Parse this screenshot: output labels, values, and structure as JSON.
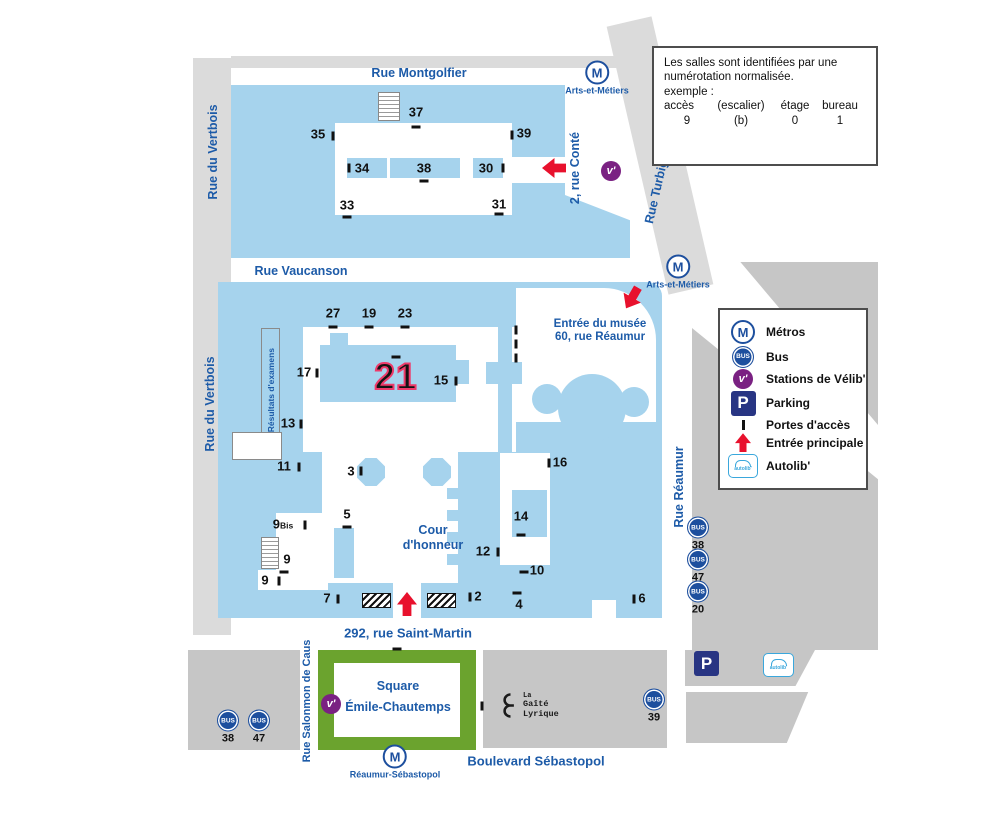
{
  "colors": {
    "campus": "#A6D3ED",
    "street": "#DBDBDB",
    "block": "#C6C6C6",
    "green": "#6BA32E",
    "blue_text": "#1D5BA8",
    "metro_blue": "#1D4F9E",
    "velib_purple": "#7A2182",
    "parking_navy": "#283583",
    "red": "#E8112D",
    "pink": "#EE3A6A"
  },
  "streets": {
    "montgolfier": "Rue Montgolfier",
    "vertbois": "Rue du Vertbois",
    "conte": "2, rue Conté",
    "turbigo": "Rue Turbigo",
    "vaucanson": "Rue Vaucanson",
    "reaumur": "Rue Réaumur",
    "saint_martin": "292, rue Saint-Martin",
    "salomon": "Rue Salonmon de Caus",
    "sebastopol": "Boulevard Sébastopol"
  },
  "places": {
    "musee1": "Entrée du musée",
    "musee2": "60, rue Réaumur",
    "cour1": "Cour",
    "cour2": "d'honneur",
    "resultats": "Résultats d'examens",
    "square1": "Square",
    "square2": "Émile-Chautemps",
    "gaite1": "La",
    "gaite2": "Gaîté",
    "gaite3": "Lyrique",
    "highlight": "21"
  },
  "icons": {
    "metro": "M",
    "bus": "BUS",
    "velib": "v'",
    "parking": "P",
    "autolib": "autolib'"
  },
  "info": {
    "l1": "Les salles sont identifiées par une",
    "l2": "numérotation normalisée.",
    "l3": "exemple :",
    "cols": [
      "accès",
      "(escalier)",
      "étage",
      "bureau"
    ],
    "vals": [
      "9",
      "(b)",
      "0",
      "1"
    ]
  },
  "legend": {
    "items": [
      {
        "label": "Métros"
      },
      {
        "label": "Bus"
      },
      {
        "label": "Stations de Vélib'"
      },
      {
        "label": "Parking"
      },
      {
        "label": "Portes d'accès"
      },
      {
        "label": "Entrée principale"
      },
      {
        "label": "Autolib'"
      }
    ]
  },
  "numbers": [
    {
      "label": "37",
      "x": 416,
      "y": 112
    },
    {
      "label": "35",
      "x": 318,
      "y": 134
    },
    {
      "label": "39",
      "x": 524,
      "y": 133
    },
    {
      "label": "34",
      "x": 362,
      "y": 168
    },
    {
      "label": "38",
      "x": 424,
      "y": 168
    },
    {
      "label": "30",
      "x": 486,
      "y": 168
    },
    {
      "label": "33",
      "x": 347,
      "y": 205
    },
    {
      "label": "31",
      "x": 499,
      "y": 204
    },
    {
      "label": "27",
      "x": 333,
      "y": 313
    },
    {
      "label": "19",
      "x": 369,
      "y": 313
    },
    {
      "label": "23",
      "x": 405,
      "y": 313
    },
    {
      "label": "17",
      "x": 304,
      "y": 372
    },
    {
      "label": "15",
      "x": 441,
      "y": 380
    },
    {
      "label": "13",
      "x": 288,
      "y": 423
    },
    {
      "label": "11",
      "x": 284,
      "y": 466
    },
    {
      "label": "3",
      "x": 351,
      "y": 471
    },
    {
      "label": "5",
      "x": 347,
      "y": 514
    },
    {
      "label": "16",
      "x": 560,
      "y": 462
    },
    {
      "label": "14",
      "x": 521,
      "y": 516
    },
    {
      "label": "12",
      "x": 483,
      "y": 551
    },
    {
      "label": "10",
      "x": 537,
      "y": 570
    },
    {
      "label": "2",
      "x": 478,
      "y": 596
    },
    {
      "label": "4",
      "x": 519,
      "y": 604
    },
    {
      "label": "6",
      "x": 642,
      "y": 598
    },
    {
      "label": "7",
      "x": 327,
      "y": 598
    },
    {
      "label": "9",
      "sub": "Bis",
      "x": 283,
      "y": 524
    },
    {
      "label": "9",
      "x": 287,
      "y": 559
    },
    {
      "label": "9",
      "x": 265,
      "y": 580
    }
  ],
  "ticks": [
    {
      "x": 416,
      "y": 127,
      "kind": "h"
    },
    {
      "x": 333,
      "y": 136,
      "kind": "v"
    },
    {
      "x": 512,
      "y": 135,
      "kind": "v"
    },
    {
      "x": 349,
      "y": 168,
      "kind": "v"
    },
    {
      "x": 424,
      "y": 181,
      "kind": "h"
    },
    {
      "x": 503,
      "y": 168,
      "kind": "v"
    },
    {
      "x": 347,
      "y": 217,
      "kind": "h"
    },
    {
      "x": 499,
      "y": 214,
      "kind": "h"
    },
    {
      "x": 333,
      "y": 327,
      "kind": "h"
    },
    {
      "x": 369,
      "y": 327,
      "kind": "h"
    },
    {
      "x": 405,
      "y": 327,
      "kind": "h"
    },
    {
      "x": 396,
      "y": 357,
      "kind": "h"
    },
    {
      "x": 317,
      "y": 373,
      "kind": "v"
    },
    {
      "x": 456,
      "y": 381,
      "kind": "v"
    },
    {
      "x": 301,
      "y": 424,
      "kind": "v"
    },
    {
      "x": 299,
      "y": 467,
      "kind": "v"
    },
    {
      "x": 361,
      "y": 471,
      "kind": "v"
    },
    {
      "x": 347,
      "y": 527,
      "kind": "h"
    },
    {
      "x": 305,
      "y": 525,
      "kind": "v"
    },
    {
      "x": 284,
      "y": 572,
      "kind": "h"
    },
    {
      "x": 279,
      "y": 581,
      "kind": "v"
    },
    {
      "x": 338,
      "y": 599,
      "kind": "v"
    },
    {
      "x": 549,
      "y": 463,
      "kind": "v"
    },
    {
      "x": 521,
      "y": 535,
      "kind": "h"
    },
    {
      "x": 498,
      "y": 552,
      "kind": "v"
    },
    {
      "x": 524,
      "y": 572,
      "kind": "h"
    },
    {
      "x": 470,
      "y": 597,
      "kind": "v"
    },
    {
      "x": 517,
      "y": 593,
      "kind": "h"
    },
    {
      "x": 634,
      "y": 599,
      "kind": "v"
    },
    {
      "x": 516,
      "y": 330,
      "kind": "v"
    },
    {
      "x": 516,
      "y": 344,
      "kind": "v"
    },
    {
      "x": 516,
      "y": 358,
      "kind": "v"
    },
    {
      "x": 397,
      "y": 649,
      "kind": "h"
    },
    {
      "x": 482,
      "y": 706,
      "kind": "v"
    }
  ],
  "bus_stops": [
    {
      "num": "38",
      "x": 228,
      "y": 727
    },
    {
      "num": "47",
      "x": 259,
      "y": 727
    },
    {
      "num": "38",
      "x": 698,
      "y": 534
    },
    {
      "num": "47",
      "x": 698,
      "y": 566
    },
    {
      "num": "20",
      "x": 698,
      "y": 598
    },
    {
      "num": "39",
      "x": 654,
      "y": 706
    }
  ],
  "metro_stations": [
    {
      "name": "Arts-et-Métiers",
      "x": 597,
      "y": 78
    },
    {
      "name": "Arts-et-Métiers",
      "x": 678,
      "y": 272
    },
    {
      "name": "Réaumur-Sébastopol",
      "x": 395,
      "y": 762
    }
  ],
  "velib_stations": [
    {
      "x": 611,
      "y": 171
    },
    {
      "x": 331,
      "y": 704
    }
  ],
  "arrows": [
    {
      "x": 544,
      "y": 156,
      "rot": -90
    },
    {
      "x": 622,
      "y": 286,
      "rot": 210
    },
    {
      "x": 397,
      "y": 592,
      "rot": 0
    }
  ],
  "stairs": [
    {
      "x": 378,
      "y": 92,
      "w": 20,
      "h": 27
    },
    {
      "x": 261,
      "y": 537,
      "w": 16,
      "h": 30
    }
  ],
  "hatches": [
    {
      "x": 362,
      "y": 593
    },
    {
      "x": 427,
      "y": 593
    }
  ]
}
